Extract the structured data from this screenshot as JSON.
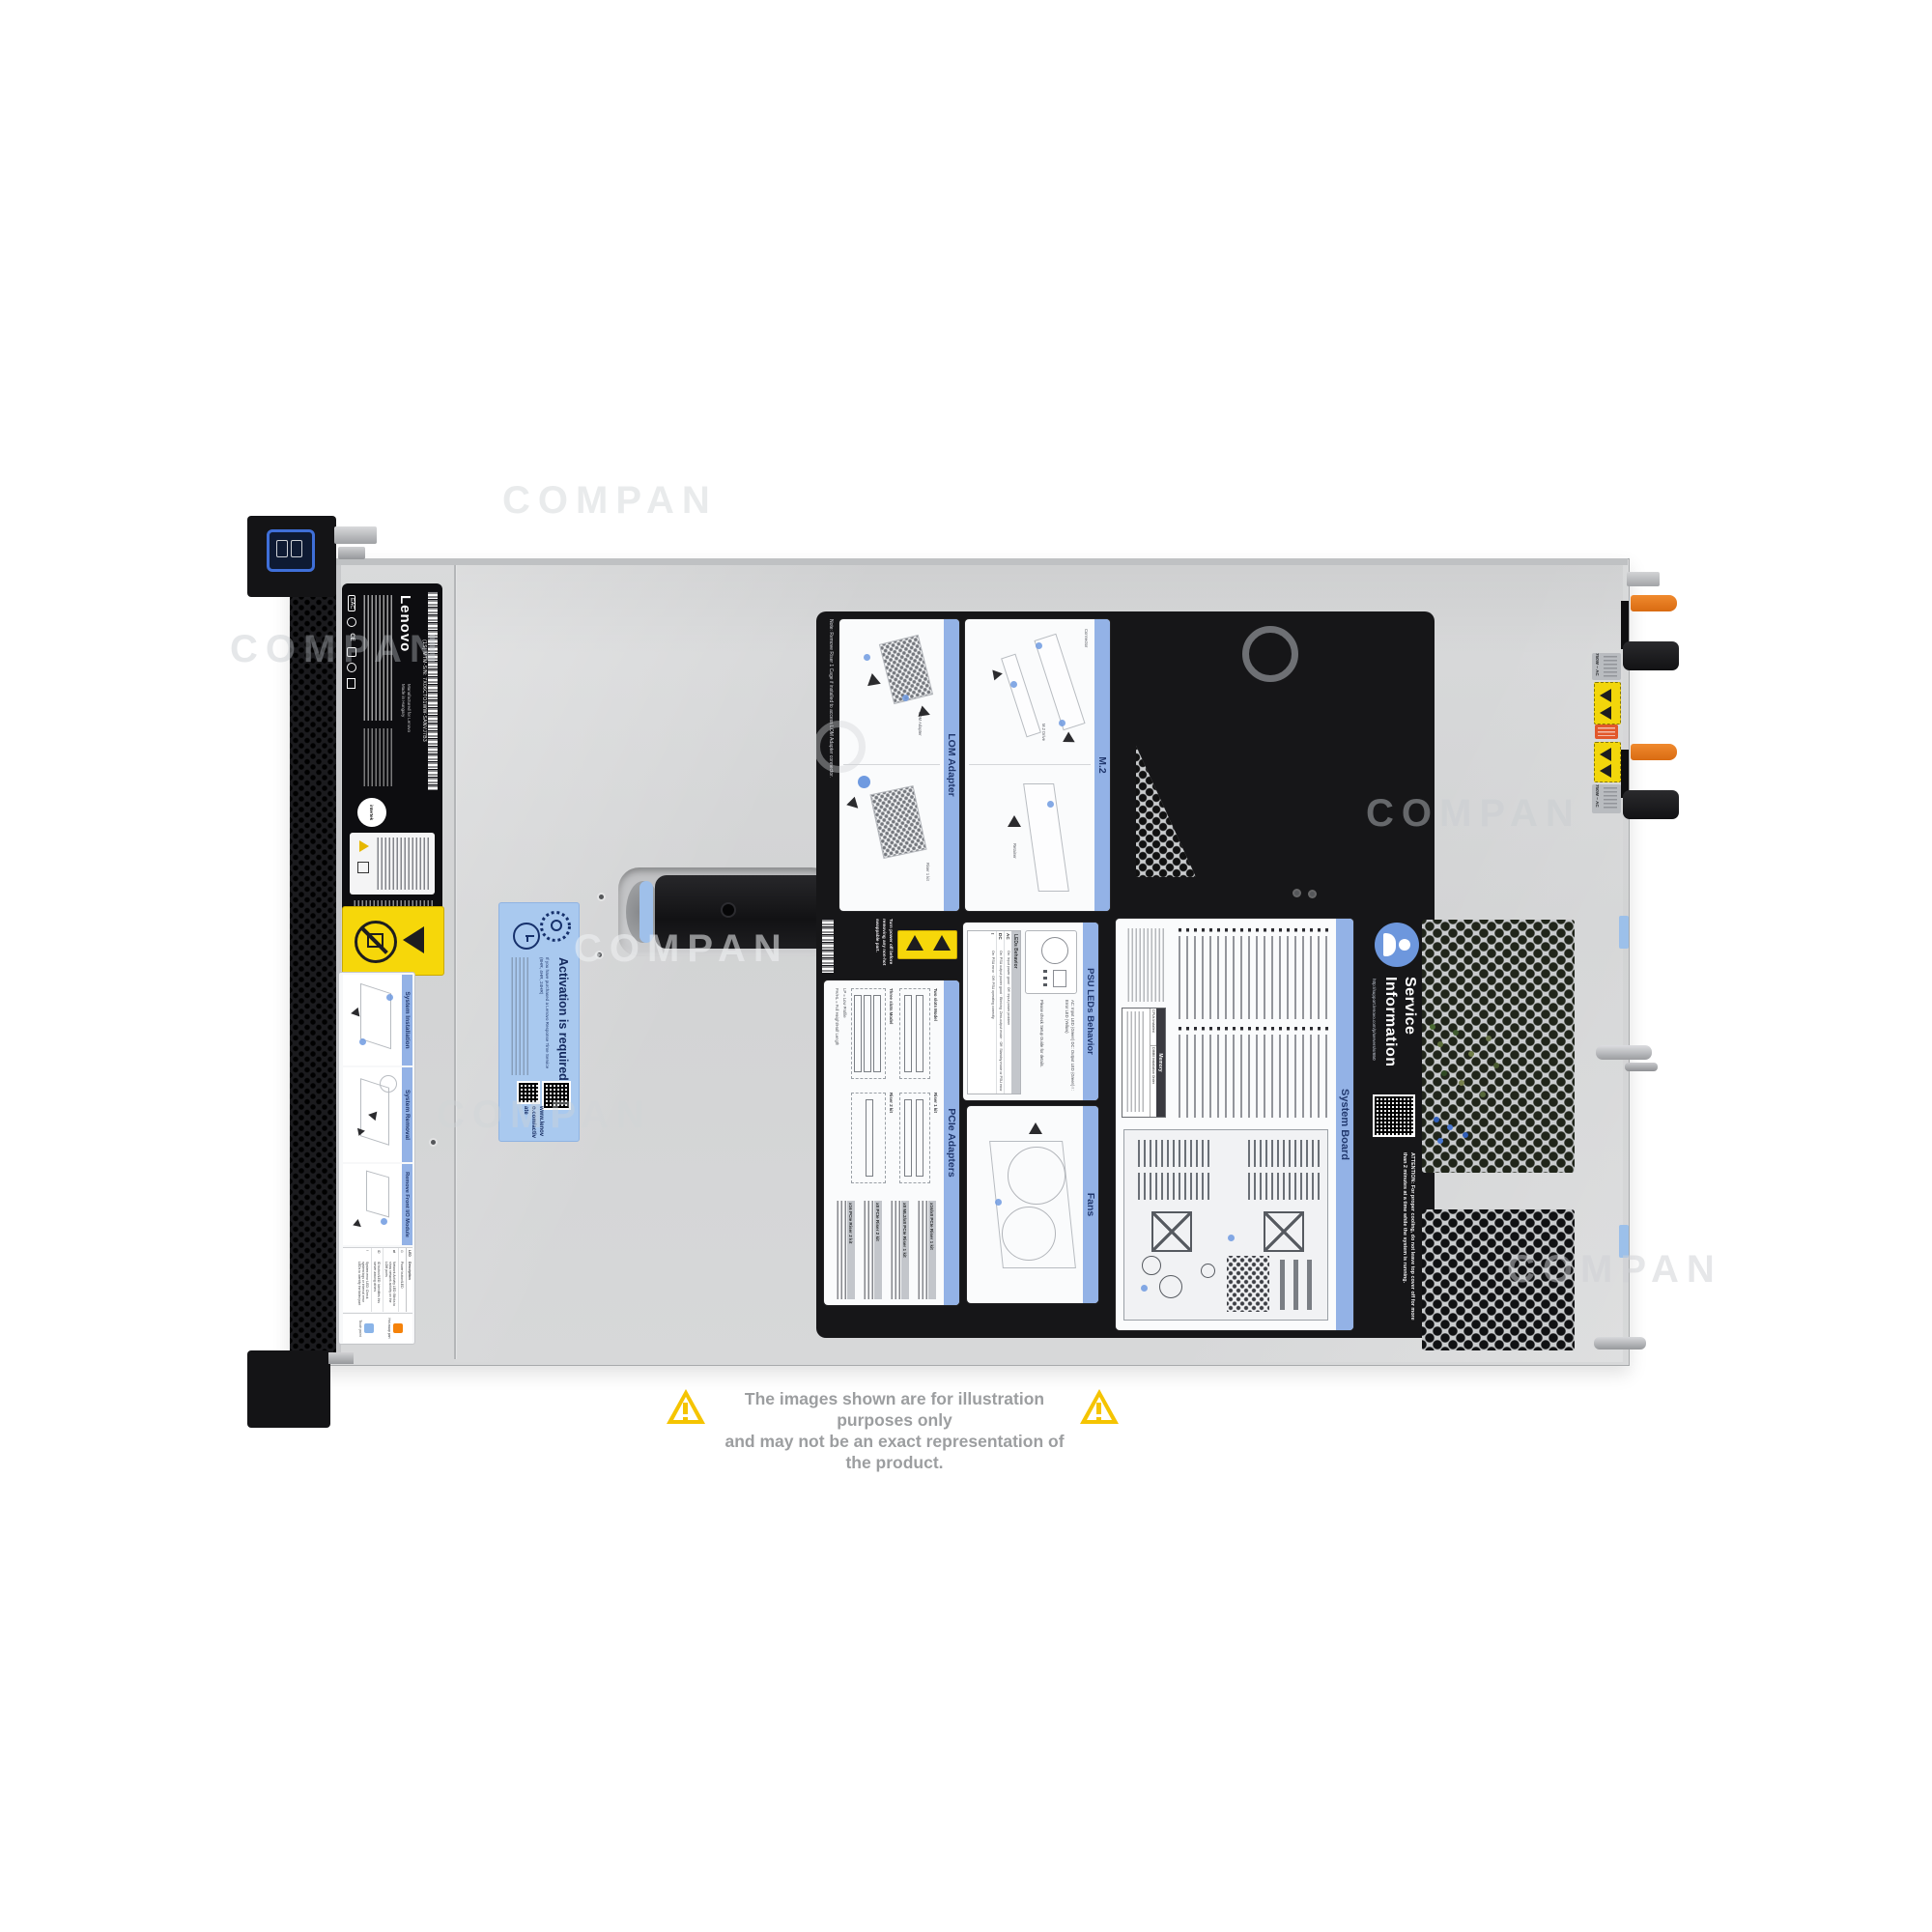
{
  "watermark": {
    "text": "COMPAN"
  },
  "disclaimer": {
    "line1": "The images shown are for illustration purposes only",
    "line2": "and may not be an exact representation of the product."
  },
  "lenovo_label": {
    "brand": "Lenovo",
    "barcode_text": "(1S) MTM-S/N: 7X06CTO1WW-SANVJ7B3",
    "made1": "Manufactured for Lenovo",
    "made2": "Made in Hungary",
    "cert": "intertek",
    "eac": "EAC",
    "ce": "CE"
  },
  "activation": {
    "title": "Activation is required",
    "note": "If you have purchased a Lenovo Response Time Service (8HR, 4HR, 24HR)",
    "url": "www.lenovo.com/activate"
  },
  "front_card": {
    "sections": [
      "System Installation",
      "System Removal",
      "Remove Front I/O Module"
    ],
    "led_header": "LED",
    "desc_header": "Description",
    "rows": [
      "Power button/LED",
      "Network Activity LED: Blinks to show network activity on the LOM ports",
      "ID button/LED: Identifies this server among others",
      "System error LED: Check system logs or internal error LEDs to identify the failed part"
    ],
    "legend": [
      {
        "label": "Hot-swap part",
        "color": "#f5820a"
      },
      {
        "label": "Touch point",
        "color": "#8ab4e8"
      }
    ]
  },
  "panel": {
    "note": "Note: Remove Riser 1 Cage if installed to access LOM Adapter connector.",
    "warning": "Turn power off before removing any non-hot swappable part.",
    "cards": {
      "lom": {
        "title": "LOM Adapter",
        "cap1": "LOM Adapter",
        "cap2": "Riser 1 kit"
      },
      "m2": {
        "title": "M.2",
        "cap1": "Connector",
        "cap2": "M.2 Drive",
        "cap3": "Retainer"
      },
      "pcie": {
        "title": "PCIe Adapters",
        "two_slots": "Two slots Model",
        "three_slots": "Three slots Model",
        "riser1": "Riser 1 kit",
        "riser2": "Riser 2 kit",
        "lp": "LP = Low Profile",
        "fh": "FH/HL = Full Height/Half Length",
        "kits": [
          "x16/x8 PCIe Riser 1 kit",
          "x8 ML2/x8 PCIe Riser 1 kit",
          "x8 PCIe Riser 2 kit",
          "x16 PCIe Riser 2 kit"
        ]
      },
      "psu": {
        "title": "PSU LEDs Behavior",
        "table_title": "LEDs Behavior",
        "rows": [
          {
            "led": "AC",
            "desc": "On: Input power good · Off: Input power problem"
          },
          {
            "led": "DC",
            "desc": "On: PSU output power good · Blinking: Zero-output mode · Off: Standby mode or PSU error"
          },
          {
            "led": "!",
            "desc": "On: PSU error · Off: PSU operating correctly"
          }
        ],
        "legend": "AC: Input LED (Green)  DC: Output LED (Green)  ! : Error LED (Yellow)",
        "note": "Please check Setup Guide for details."
      },
      "fans": {
        "title": "Fans"
      },
      "board": {
        "title": "System Board",
        "memory": "Memory",
        "mem_h1": "CPUs Installed",
        "mem_h2": "DIMM Installation Order"
      }
    },
    "service": {
      "title1": "Service",
      "title2": "Information",
      "url": "http://support.lenovo.com/p/servers/sr650",
      "attention": "ATTENTION: For proper cooling, do not leave top cover off for more than 2 minutes at a time while the system is running."
    }
  },
  "rear": {
    "psu_rating": "750W ~ AC"
  }
}
